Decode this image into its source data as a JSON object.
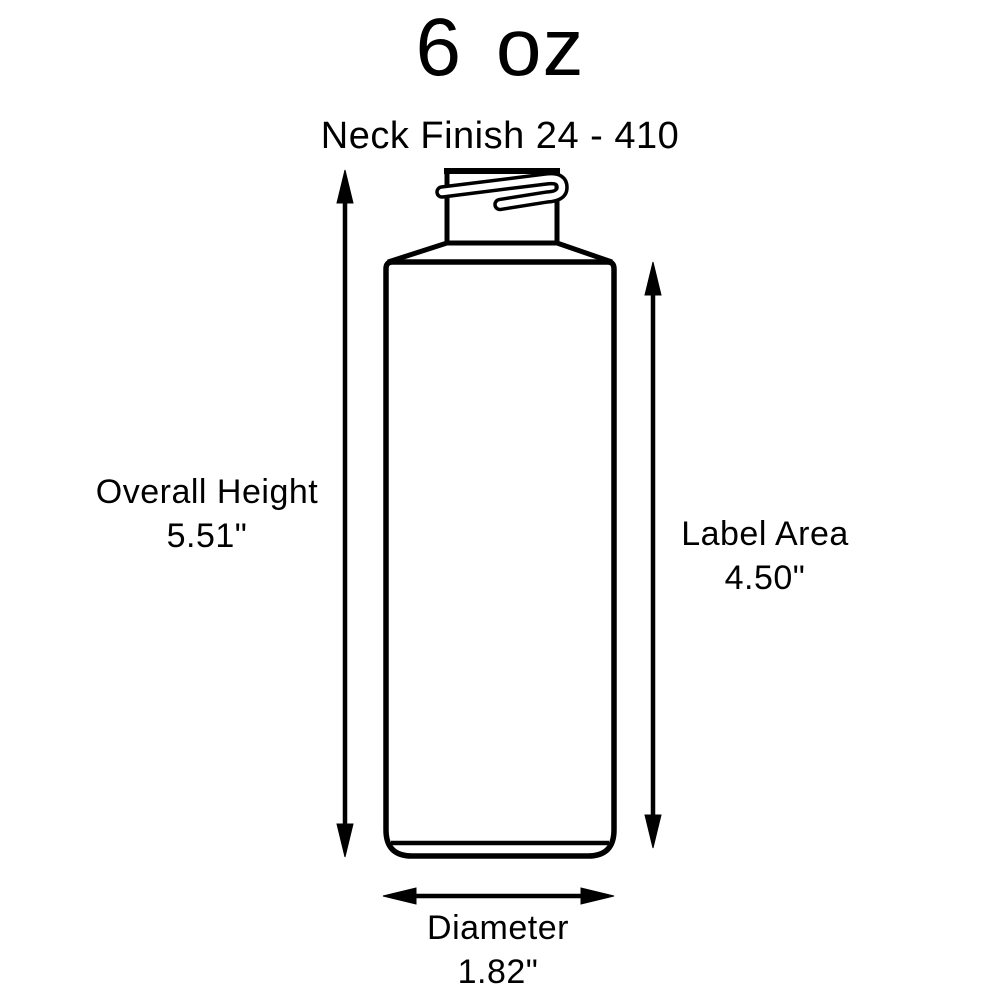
{
  "title": {
    "text": "6 oz"
  },
  "neck": {
    "finish_label": "Neck Finish 24 - 410"
  },
  "dimensions": {
    "overall_height": {
      "label": "Overall Height",
      "value": "5.51\""
    },
    "label_area": {
      "label": "Label Area",
      "value": "4.50\""
    },
    "diameter": {
      "label": "Diameter",
      "value": "1.82\""
    }
  },
  "colors": {
    "line": "#000000",
    "text": "#000000",
    "background": "#ffffff"
  }
}
